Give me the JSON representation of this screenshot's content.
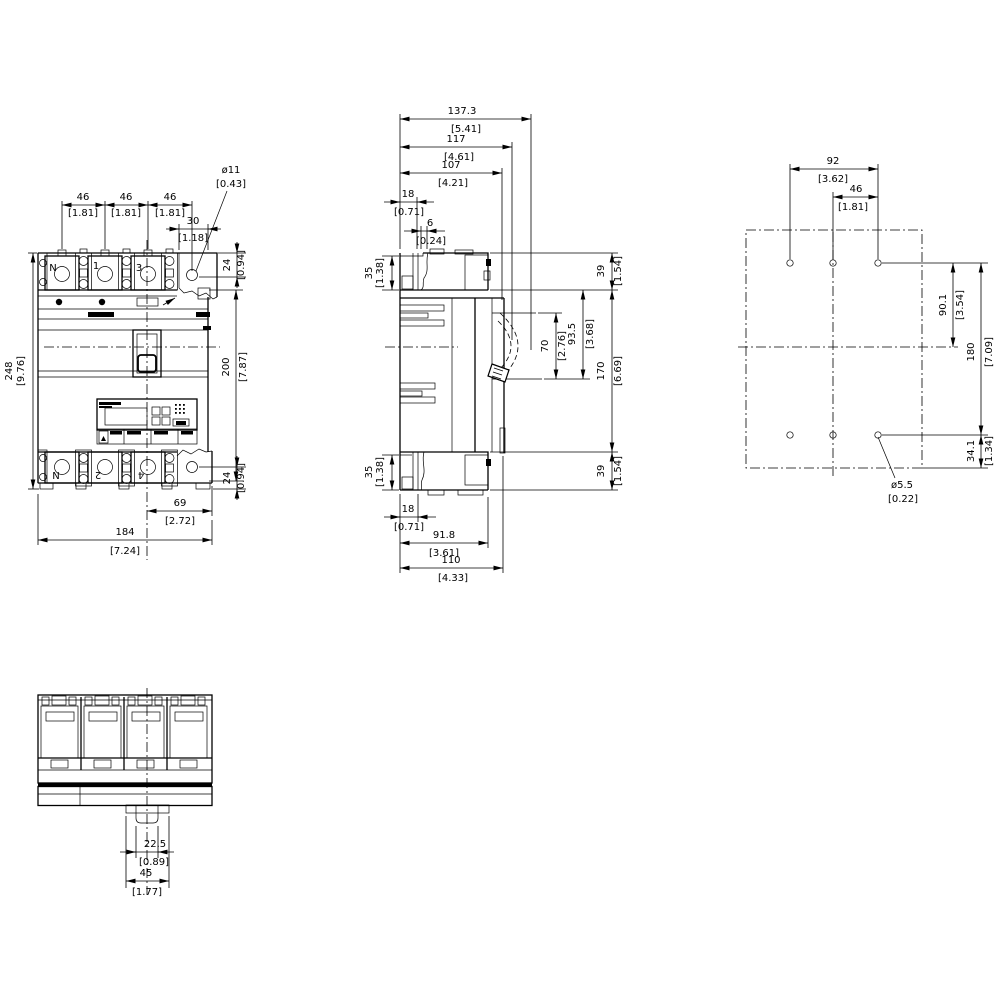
{
  "front_view": {
    "terminals_top": [
      "N",
      "1",
      "3"
    ],
    "terminals_bottom": [
      "N",
      "2",
      "4"
    ],
    "dims": {
      "pole_pitch": {
        "mm": "46",
        "inch": "[1.81]"
      },
      "terminal_hole_dia": {
        "mm": "ø11",
        "inch": "[0.43]"
      },
      "hole_to_edge": {
        "mm": "30",
        "inch": "[1.18]"
      },
      "hole_center_from_top": {
        "mm": "24",
        "inch": "[0.94]"
      },
      "hole_center_from_bottom": {
        "mm": "24",
        "inch": "[0.94]"
      },
      "overall_height": {
        "mm": "248",
        "inch": "[9.76]"
      },
      "housing_height": {
        "mm": "200",
        "inch": "[7.87]"
      },
      "center_to_right_edge": {
        "mm": "69",
        "inch": "[2.72]"
      },
      "overall_width": {
        "mm": "184",
        "inch": "[7.24]"
      }
    }
  },
  "side_view": {
    "dims": {
      "depth_overall": {
        "mm": "137.3",
        "inch": "[5.41]"
      },
      "depth_to_handle": {
        "mm": "117",
        "inch": "[4.61]"
      },
      "depth_to_escutcheon": {
        "mm": "107",
        "inch": "[4.21]"
      },
      "rear_offset_top": {
        "mm": "18",
        "inch": "[0.71]"
      },
      "step": {
        "mm": "6",
        "inch": "[0.24]"
      },
      "terminal_height_rear_top": {
        "mm": "35",
        "inch": "[1.38]"
      },
      "terminal_height_front_top": {
        "mm": "39",
        "inch": "[1.54]"
      },
      "handle_window_height": {
        "mm": "70",
        "inch": "[2.76]"
      },
      "escutcheon_height": {
        "mm": "93.5",
        "inch": "[3.68]"
      },
      "body_height": {
        "mm": "170",
        "inch": "[6.69]"
      },
      "terminal_height_rear_bottom": {
        "mm": "35",
        "inch": "[1.38]"
      },
      "terminal_height_front_bottom": {
        "mm": "39",
        "inch": "[1.54]"
      },
      "rear_offset_bottom": {
        "mm": "18",
        "inch": "[0.71]"
      },
      "base_depth": {
        "mm": "91.8",
        "inch": "[3.61]"
      },
      "depth_to_front_molding": {
        "mm": "110",
        "inch": "[4.33]"
      }
    }
  },
  "drill_plan": {
    "dims": {
      "outer_hole_span": {
        "mm": "92",
        "inch": "[3.62]"
      },
      "hole_pitch": {
        "mm": "46",
        "inch": "[1.81]"
      },
      "top_row_to_center": {
        "mm": "90.1",
        "inch": "[3.54]"
      },
      "row_spacing": {
        "mm": "180",
        "inch": "[7.09]"
      },
      "bottom_row_to_edge": {
        "mm": "34.1",
        "inch": "[1.34]"
      },
      "drill_dia": {
        "mm": "ø5.5",
        "inch": "[0.22]"
      }
    }
  },
  "bottom_view": {
    "dims": {
      "clip_inner_width": {
        "mm": "22.5",
        "inch": "[0.89]"
      },
      "clip_outer_width": {
        "mm": "45",
        "inch": "[1.77]"
      }
    }
  }
}
